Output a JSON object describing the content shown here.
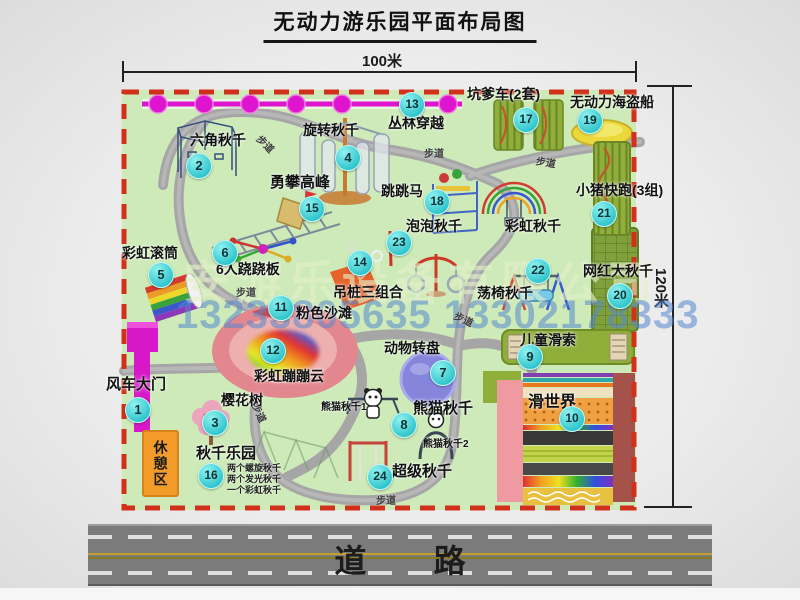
{
  "title": "无动力游乐园平面布局图",
  "dimensions": {
    "top": "100米",
    "right": "120米"
  },
  "watermark": {
    "company": "安游乐设备有限公司",
    "phone": "13233805635 13302178333"
  },
  "road": {
    "label": "道路"
  },
  "rest_area": {
    "label": "休憩区"
  },
  "walkway_text": "步道",
  "colors": {
    "park_green": "#cdeab8",
    "border_red": "#d1301a",
    "badge_cyan": "#3ad0d4",
    "magenta": "#de14ce",
    "road_gray": "#7b7b7b",
    "equipment_green": "#8fae3a",
    "rest_orange": "#f29b28",
    "pink_beach": "#e2878d"
  },
  "park": {
    "pois": [
      {
        "num": 1,
        "label": "风车大门",
        "badge": {
          "x": 137,
          "y": 409
        },
        "label_pos": {
          "x": 106,
          "y": 377,
          "size": 15
        }
      },
      {
        "num": 2,
        "label": "六角秋千",
        "badge": {
          "x": 198,
          "y": 165
        },
        "label_pos": {
          "x": 190,
          "y": 133,
          "size": 14
        }
      },
      {
        "num": 3,
        "label": "樱花树",
        "badge": {
          "x": 214,
          "y": 422
        },
        "label_pos": {
          "x": 221,
          "y": 393,
          "size": 14
        }
      },
      {
        "num": 4,
        "label": "旋转秋千",
        "badge": {
          "x": 347,
          "y": 157
        },
        "label_pos": {
          "x": 303,
          "y": 123,
          "size": 14
        }
      },
      {
        "num": 5,
        "label": "彩虹滚筒",
        "badge": {
          "x": 160,
          "y": 274
        },
        "label_pos": {
          "x": 122,
          "y": 246,
          "size": 14
        }
      },
      {
        "num": 6,
        "label": "6人跷跷板",
        "badge": {
          "x": 224,
          "y": 252
        },
        "label_pos": {
          "x": 216,
          "y": 262,
          "size": 14
        }
      },
      {
        "num": 7,
        "label": "动物转盘",
        "badge": {
          "x": 442,
          "y": 372
        },
        "label_pos": {
          "x": 384,
          "y": 341,
          "size": 14
        }
      },
      {
        "num": 8,
        "label": "熊猫秋千",
        "badge": {
          "x": 403,
          "y": 424
        },
        "label_pos": {
          "x": 413,
          "y": 401,
          "size": 15
        }
      },
      {
        "num": 9,
        "label": "儿童滑索",
        "badge": {
          "x": 529,
          "y": 356
        },
        "label_pos": {
          "x": 520,
          "y": 333,
          "size": 14
        }
      },
      {
        "num": 10,
        "label": "滑世界",
        "badge": {
          "x": 571,
          "y": 418
        },
        "label_pos": {
          "x": 528,
          "y": 395,
          "size": 16
        }
      },
      {
        "num": 11,
        "label": "粉色沙滩",
        "badge": {
          "x": 280,
          "y": 307
        },
        "label_pos": {
          "x": 296,
          "y": 306,
          "size": 14
        }
      },
      {
        "num": 12,
        "label": "彩虹蹦蹦云",
        "badge": {
          "x": 272,
          "y": 350
        },
        "label_pos": {
          "x": 254,
          "y": 369,
          "size": 14
        }
      },
      {
        "num": 13,
        "label": "丛林穿越",
        "badge": {
          "x": 411,
          "y": 104
        },
        "label_pos": {
          "x": 388,
          "y": 116,
          "size": 14
        }
      },
      {
        "num": 14,
        "label": "吊桩三组合",
        "badge": {
          "x": 359,
          "y": 262
        },
        "label_pos": {
          "x": 333,
          "y": 285,
          "size": 14
        }
      },
      {
        "num": 15,
        "label": "勇攀高峰",
        "badge": {
          "x": 311,
          "y": 208
        },
        "label_pos": {
          "x": 270,
          "y": 175,
          "size": 15
        }
      },
      {
        "num": 16,
        "label": "秋千乐园",
        "badge": {
          "x": 210,
          "y": 475
        },
        "label_pos": {
          "x": 196,
          "y": 446,
          "size": 15
        },
        "sub": [
          "两个螺旋秋千",
          "两个发光秋千",
          "一个彩虹秋千"
        ],
        "sub_pos": {
          "x": 227,
          "y": 464
        }
      },
      {
        "num": 17,
        "label": "坑爹车(2套)",
        "badge": {
          "x": 525,
          "y": 119
        },
        "label_pos": {
          "x": 467,
          "y": 87,
          "size": 14
        }
      },
      {
        "num": 18,
        "label": "跳跳马",
        "badge": {
          "x": 436,
          "y": 201
        },
        "label_pos": {
          "x": 381,
          "y": 184,
          "size": 14
        }
      },
      {
        "num": 19,
        "label": "无动力海盗船",
        "badge": {
          "x": 589,
          "y": 120
        },
        "label_pos": {
          "x": 570,
          "y": 95,
          "size": 14
        }
      },
      {
        "num": 20,
        "label": "网红大秋千",
        "badge": {
          "x": 619,
          "y": 295
        },
        "label_pos": {
          "x": 583,
          "y": 264,
          "size": 14
        }
      },
      {
        "num": 21,
        "label": "小猪快跑(3组)",
        "badge": {
          "x": 603,
          "y": 213
        },
        "label_pos": {
          "x": 576,
          "y": 183,
          "size": 14
        }
      },
      {
        "num": 22,
        "label": "荡椅秋千",
        "badge": {
          "x": 537,
          "y": 270
        },
        "label_pos": {
          "x": 477,
          "y": 286,
          "size": 14
        }
      },
      {
        "num": 23,
        "label": "泡泡秋千",
        "badge": {
          "x": 398,
          "y": 242
        },
        "label_pos": {
          "x": 406,
          "y": 219,
          "size": 14
        }
      },
      {
        "num": 24,
        "label": "超级秋千",
        "badge": {
          "x": 379,
          "y": 476
        },
        "label_pos": {
          "x": 392,
          "y": 464,
          "size": 15
        }
      }
    ],
    "extra_labels": [
      {
        "text": "彩虹秋千",
        "x": 505,
        "y": 219,
        "size": 14
      },
      {
        "text": "熊猫秋千1",
        "x": 321,
        "y": 403,
        "size": 10
      },
      {
        "text": "熊猫秋千2",
        "x": 423,
        "y": 440,
        "size": 10
      }
    ],
    "walkway_labels": [
      {
        "x": 256,
        "y": 136,
        "rot": 45
      },
      {
        "x": 424,
        "y": 145,
        "rot": 0
      },
      {
        "x": 536,
        "y": 154,
        "rot": 10
      },
      {
        "x": 236,
        "y": 284,
        "rot": 0
      },
      {
        "x": 454,
        "y": 311,
        "rot": 25
      },
      {
        "x": 250,
        "y": 405,
        "rot": 65
      },
      {
        "x": 376,
        "y": 492,
        "rot": 0
      }
    ]
  }
}
